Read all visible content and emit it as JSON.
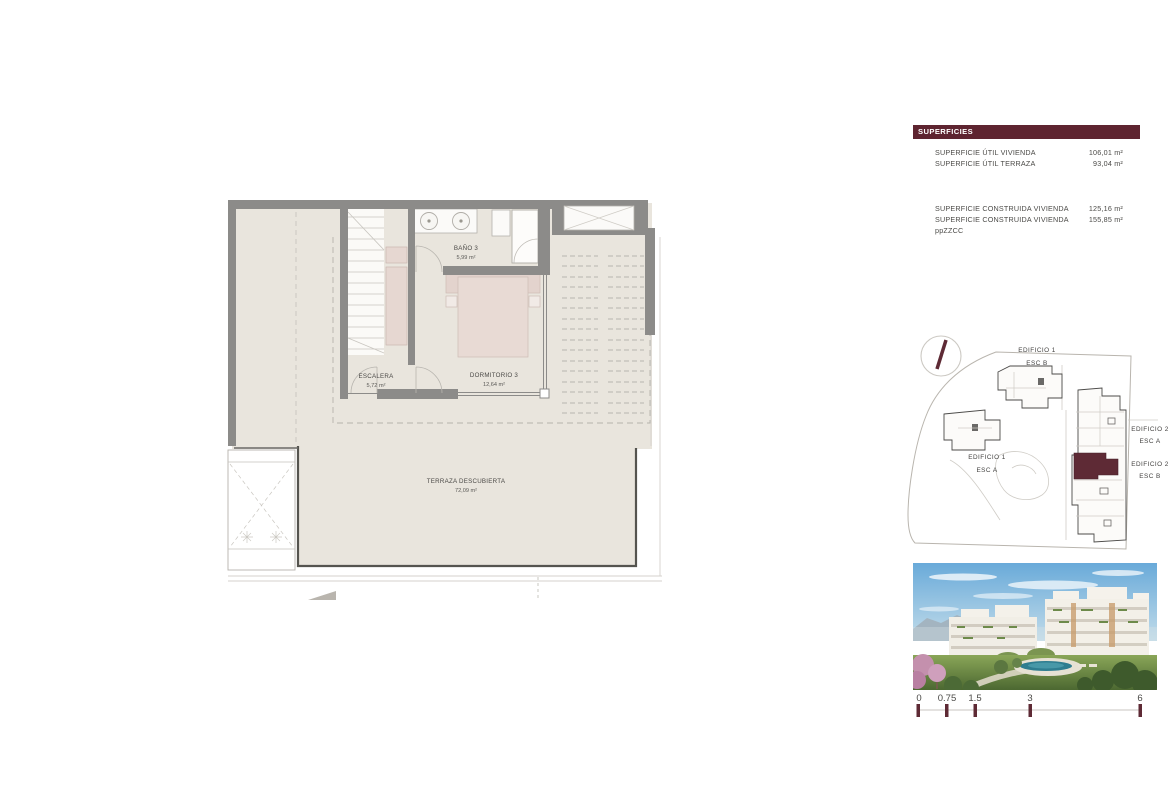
{
  "superficies": {
    "title": "SUPERFICIES",
    "util": [
      {
        "label": "SUPERFICIE ÚTIL VIVIENDA",
        "value": "106,01 m²"
      },
      {
        "label": "SUPERFICIE ÚTIL TERRAZA",
        "value": "93,04 m²"
      }
    ],
    "construida": [
      {
        "label": "SUPERFICIE CONSTRUIDA VIVIENDA",
        "value": "125,16 m²"
      },
      {
        "label": "SUPERFICIE CONSTRUIDA VIVIENDA ppZZCC",
        "value": "155,85 m²"
      }
    ]
  },
  "floorplan": {
    "rooms": [
      {
        "name": "BAÑO 3",
        "area": "5,99 m²"
      },
      {
        "name": "ESCALERA",
        "area": "5,72 m²"
      },
      {
        "name": "DORMITORIO 3",
        "area": "12,64 m²"
      },
      {
        "name": "TERRAZA DESCUBIERTA",
        "area": "72,09 m²"
      }
    ]
  },
  "siteplan": {
    "labels": {
      "e1b": {
        "building": "EDIFICIO 1",
        "stair": "ESC B"
      },
      "e1a": {
        "building": "EDIFICIO 1",
        "stair": "ESC A"
      },
      "e2a": {
        "building": "EDIFICIO 2",
        "stair": "ESC A"
      },
      "e2b": {
        "building": "EDIFICIO 2",
        "stair": "ESC B"
      }
    }
  },
  "scalebar": {
    "ticks": [
      "0",
      "0.75",
      "1.5",
      "3",
      "6"
    ]
  },
  "colors": {
    "accent_maroon": "#5e2430",
    "plan_floor": "#e9e5dd",
    "wall_gray": "#8c8b89",
    "furniture_pink": "#e6d7d1"
  }
}
